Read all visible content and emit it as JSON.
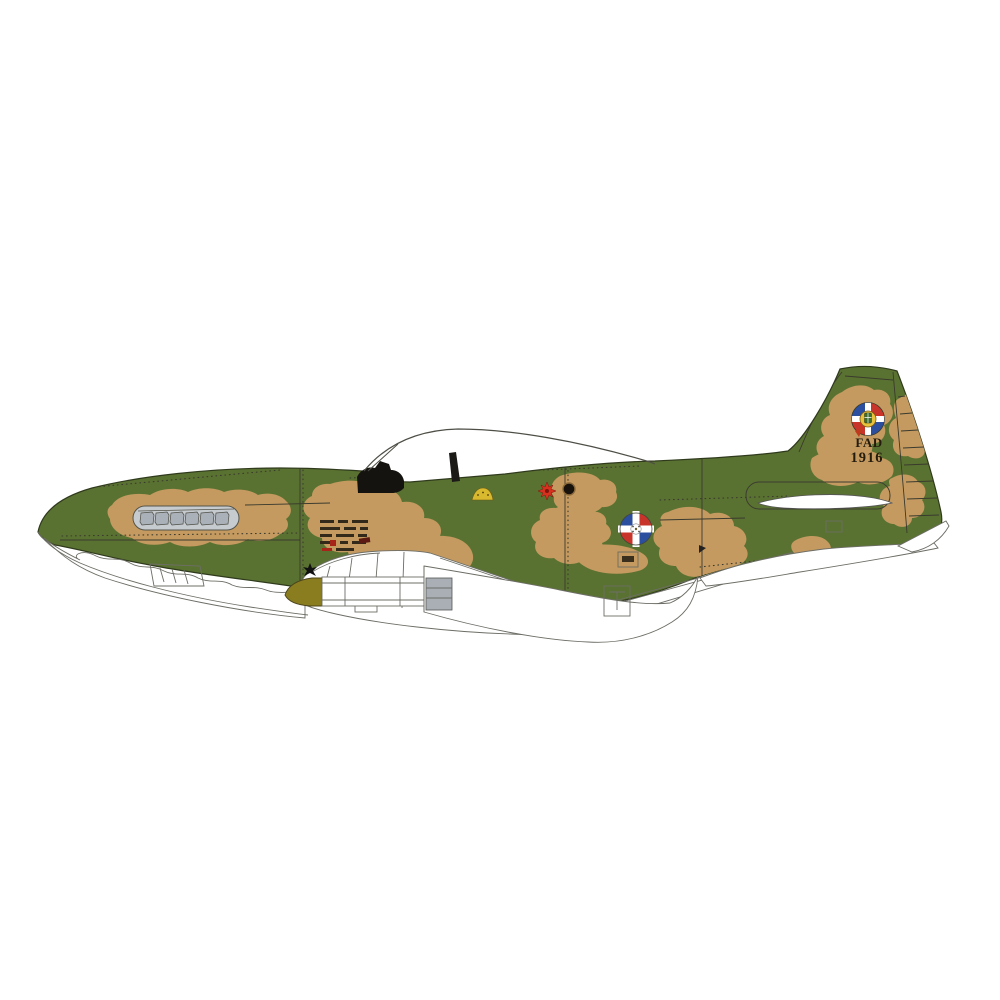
{
  "page": {
    "description": "Side-profile colour-scheme illustration of a camouflaged P-51D Mustang fighter of the Dominican Air Force on a plain white background"
  },
  "aircraft": {
    "tail_code": "FAD",
    "tail_number": "1916",
    "markings": {
      "fuselage_roundel": "Dominican quartered blue/red roundel with white cross",
      "tail_badge": "Dominican coat-of-arms disc badge above tail code",
      "fuel_filler": "red starburst beside black filler cap",
      "data_stencil": "small black stencil data block at wing root"
    }
  },
  "colors": {
    "canvas": "#ffffff",
    "camo_green": "#5a7231",
    "camo_tan": "#c49a60",
    "outline": "#2f3a1c",
    "line_art": "#6d6d66",
    "exhaust_gray": "#c6cbd0",
    "exhaust_stack": "#aab1b9",
    "tank_olive": "#8a7d20",
    "roundel_blue": "#2b4f9e",
    "roundel_red": "#c8342a",
    "star_red": "#d6311f",
    "marking_yellow": "#d9b92d",
    "badge_gold": "#e9c23c"
  }
}
